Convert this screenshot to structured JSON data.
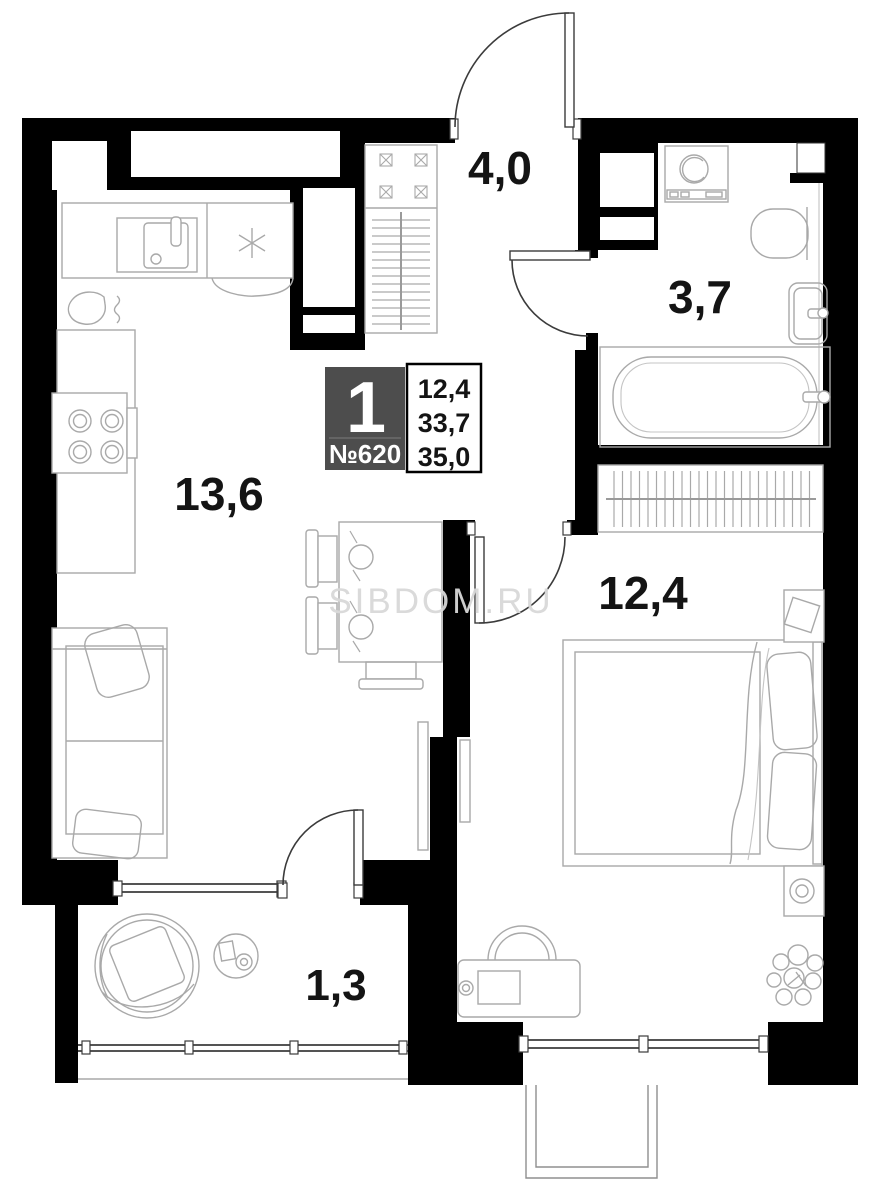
{
  "apartment": {
    "rooms_count": "1",
    "number": "№620",
    "area_values": [
      "12,4",
      "33,7",
      "35,0"
    ]
  },
  "rooms": [
    {
      "name": "kitchen-living-room",
      "area": "13,6"
    },
    {
      "name": "hallway",
      "area": "4,0"
    },
    {
      "name": "bathroom",
      "area": "3,7"
    },
    {
      "name": "bedroom",
      "area": "12,4"
    },
    {
      "name": "balcony",
      "area": "1,3"
    }
  ],
  "watermark": "SIBDOM.RU",
  "colors": {
    "wall": "#000000",
    "furniture_line": "#a9a9a9",
    "door_line": "#3b3b3b",
    "badge_bg": "#4d4d4d",
    "badge_text": "#ffffff",
    "label_text": "#141414",
    "watermark": "#d9d9d9"
  }
}
